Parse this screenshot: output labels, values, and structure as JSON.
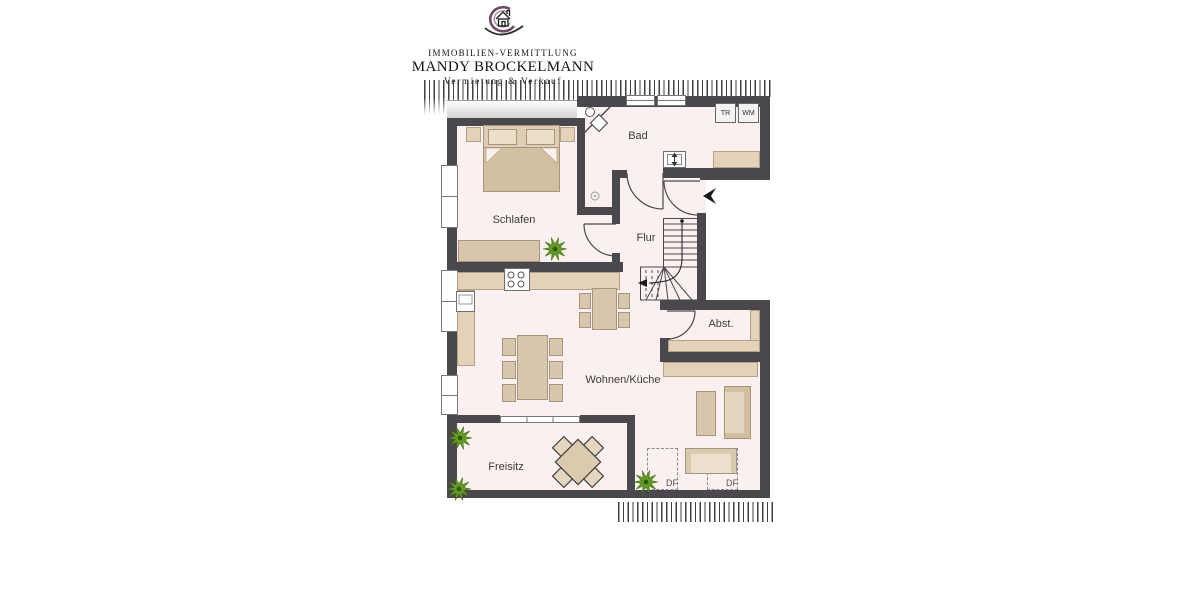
{
  "logo": {
    "line1": "IMMOBILIEN-VERMITTLUNG",
    "line2": "MANDY BROCKELMANN",
    "line3": "Vermietung & Verkauf"
  },
  "rooms": {
    "schlafen": "Schlafen",
    "bad": "Bad",
    "flur": "Flur",
    "abst": "Abst.",
    "wohnen": "Wohnen/Küche",
    "freisitz": "Freisitz"
  },
  "bad": {
    "appliances": {
      "dryer": "TR",
      "washer": "WM"
    }
  },
  "roof_windows": {
    "df1": "DF",
    "df2": "DF"
  },
  "colors": {
    "wall": "#4a484d",
    "floor": "#faf0ef",
    "furniture": "#d9c7ad",
    "plant": "#639c27",
    "logo_accent": "#6e4c68"
  }
}
